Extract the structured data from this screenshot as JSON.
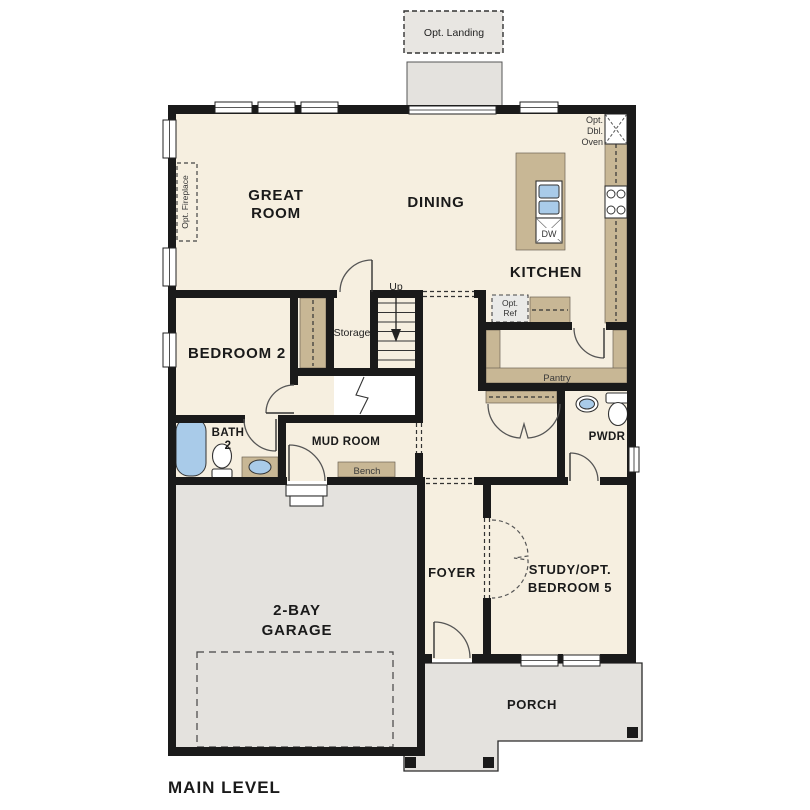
{
  "plan": {
    "title": "MAIN LEVEL",
    "labels": {
      "opt_landing": "Opt. Landing",
      "opt_fireplace": "Opt. Fireplace",
      "great_room_1": "GREAT",
      "great_room_2": "ROOM",
      "dining": "DINING",
      "kitchen": "KITCHEN",
      "oven_1": "Opt.",
      "oven_2": "Dbl.",
      "oven_3": "Oven",
      "dw": "DW",
      "ref_1": "Opt.",
      "ref_2": "Ref",
      "pantry": "Pantry",
      "bedroom2": "BEDROOM 2",
      "storage": "Storage",
      "up": "Up",
      "bath2_1": "BATH",
      "bath2_2": "2",
      "mud_room": "MUD ROOM",
      "bench": "Bench",
      "pwdr": "PWDR",
      "foyer": "FOYER",
      "study_1": "STUDY/OPT.",
      "study_2": "BEDROOM 5",
      "garage_1": "2-BAY",
      "garage_2": "GARAGE",
      "porch": "PORCH"
    },
    "colors": {
      "floor": "#f6efe0",
      "wall": "#1a1a1a",
      "casework": "#c8b795",
      "concrete": "#e4e2de",
      "fixture_blue": "#a9cbe9",
      "door_line": "#555555"
    }
  }
}
